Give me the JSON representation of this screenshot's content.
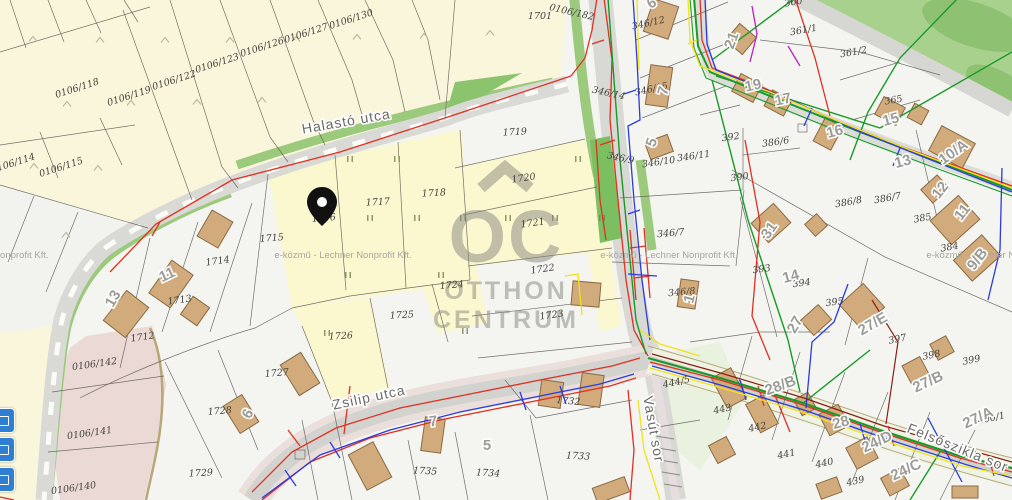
{
  "app": {
    "name": "cadastral-utility-map"
  },
  "watermark": {
    "logo_mark": "OC",
    "logo_line1": "OTTHON",
    "logo_line2": "CENTRUM",
    "provider": "e-közmű - Lechner Nonprofit Kft.",
    "provider_rows": [
      {
        "x": -20,
        "y": 258
      },
      {
        "x": 343,
        "y": 258
      },
      {
        "x": 669,
        "y": 258
      },
      {
        "x": 995,
        "y": 258
      }
    ]
  },
  "pin": {
    "parcel": "1716",
    "color": "#111111"
  },
  "streets": [
    {
      "t": "Halastó utca",
      "x": 347,
      "y": 126,
      "r": -10
    },
    {
      "t": "Zsilip utca",
      "x": 370,
      "y": 402,
      "r": -12
    },
    {
      "t": "Felsőszikla sor",
      "x": 956,
      "y": 452,
      "r": 22
    },
    {
      "t": "Vasút sor",
      "x": 649,
      "y": 430,
      "r": 80
    }
  ],
  "parcel_labels": [
    {
      "t": "0106/114",
      "x": 14,
      "y": 166,
      "r": -18
    },
    {
      "t": "0106/115",
      "x": 62,
      "y": 170,
      "r": -18
    },
    {
      "t": "0106/118",
      "x": 78,
      "y": 91,
      "r": -18
    },
    {
      "t": "0106/119",
      "x": 130,
      "y": 99,
      "r": -18
    },
    {
      "t": "0106/122",
      "x": 175,
      "y": 83,
      "r": -18
    },
    {
      "t": "0106/123",
      "x": 218,
      "y": 66,
      "r": -18
    },
    {
      "t": "0106/126",
      "x": 263,
      "y": 50,
      "r": -18
    },
    {
      "t": "0106/127",
      "x": 307,
      "y": 36,
      "r": -18
    },
    {
      "t": "0106/130",
      "x": 352,
      "y": 22,
      "r": -18
    },
    {
      "t": "1701",
      "x": 540,
      "y": 19,
      "r": 0
    },
    {
      "t": "0106/182",
      "x": 571,
      "y": 15,
      "r": 13
    },
    {
      "t": "0106/142",
      "x": 95,
      "y": 367,
      "r": -8
    },
    {
      "t": "0106/141",
      "x": 90,
      "y": 436,
      "r": -8
    },
    {
      "t": "0106/140",
      "x": 74,
      "y": 491,
      "r": -8
    },
    {
      "t": "1712",
      "x": 143,
      "y": 340,
      "r": -8
    },
    {
      "t": "1713",
      "x": 180,
      "y": 303,
      "r": -8
    },
    {
      "t": "1714",
      "x": 218,
      "y": 264,
      "r": -8
    },
    {
      "t": "1715",
      "x": 272,
      "y": 241,
      "r": -5
    },
    {
      "t": "1716",
      "x": 324,
      "y": 221,
      "r": -5
    },
    {
      "t": "1717",
      "x": 378,
      "y": 205,
      "r": -3
    },
    {
      "t": "1718",
      "x": 434,
      "y": 196,
      "r": -3
    },
    {
      "t": "1719",
      "x": 515,
      "y": 135,
      "r": -3
    },
    {
      "t": "1720",
      "x": 524,
      "y": 181,
      "r": -8
    },
    {
      "t": "1721",
      "x": 533,
      "y": 226,
      "r": -8
    },
    {
      "t": "1722",
      "x": 543,
      "y": 272,
      "r": -8
    },
    {
      "t": "1723",
      "x": 552,
      "y": 318,
      "r": -8
    },
    {
      "t": "1724",
      "x": 452,
      "y": 288,
      "r": -5
    },
    {
      "t": "1725",
      "x": 402,
      "y": 318,
      "r": -3
    },
    {
      "t": "1726",
      "x": 341,
      "y": 339,
      "r": -3
    },
    {
      "t": "1727",
      "x": 277,
      "y": 376,
      "r": -5
    },
    {
      "t": "1728",
      "x": 220,
      "y": 414,
      "r": -5
    },
    {
      "t": "1729",
      "x": 201,
      "y": 476,
      "r": -3
    },
    {
      "t": "1732",
      "x": 568,
      "y": 404,
      "r": 5
    },
    {
      "t": "1733",
      "x": 578,
      "y": 459,
      "r": 3
    },
    {
      "t": "1734",
      "x": 488,
      "y": 476,
      "r": 3
    },
    {
      "t": "1735",
      "x": 425,
      "y": 474,
      "r": 3
    },
    {
      "t": "346/12",
      "x": 649,
      "y": 26,
      "r": -12
    },
    {
      "t": "346/14",
      "x": 608,
      "y": 96,
      "r": 12
    },
    {
      "t": "346/15",
      "x": 652,
      "y": 92,
      "r": -12
    },
    {
      "t": "346/9",
      "x": 620,
      "y": 161,
      "r": 12
    },
    {
      "t": "346/10",
      "x": 659,
      "y": 165,
      "r": -8
    },
    {
      "t": "346/11",
      "x": 694,
      "y": 159,
      "r": -8
    },
    {
      "t": "392",
      "x": 731,
      "y": 140,
      "r": -8
    },
    {
      "t": "386/6",
      "x": 776,
      "y": 145,
      "r": -8
    },
    {
      "t": "390",
      "x": 740,
      "y": 180,
      "r": -8
    },
    {
      "t": "346/7",
      "x": 671,
      "y": 236,
      "r": -5
    },
    {
      "t": "346/8",
      "x": 682,
      "y": 295,
      "r": -5
    },
    {
      "t": "393",
      "x": 762,
      "y": 272,
      "r": -8
    },
    {
      "t": "386/8",
      "x": 849,
      "y": 205,
      "r": -10
    },
    {
      "t": "386/7",
      "x": 888,
      "y": 201,
      "r": -10
    },
    {
      "t": "385",
      "x": 923,
      "y": 221,
      "r": -10
    },
    {
      "t": "384",
      "x": 950,
      "y": 250,
      "r": -10
    },
    {
      "t": "394",
      "x": 802,
      "y": 286,
      "r": -8
    },
    {
      "t": "395",
      "x": 835,
      "y": 305,
      "r": -8
    },
    {
      "t": "361/1",
      "x": 804,
      "y": 33,
      "r": -10
    },
    {
      "t": "361/2",
      "x": 854,
      "y": 55,
      "r": -10
    },
    {
      "t": "365",
      "x": 894,
      "y": 103,
      "r": -10
    },
    {
      "t": "360",
      "x": 794,
      "y": 5,
      "r": -10
    },
    {
      "t": "397",
      "x": 898,
      "y": 342,
      "r": -12
    },
    {
      "t": "398",
      "x": 932,
      "y": 358,
      "r": -12
    },
    {
      "t": "399",
      "x": 972,
      "y": 363,
      "r": -12
    },
    {
      "t": "400/1",
      "x": 992,
      "y": 421,
      "r": -12
    },
    {
      "t": "439",
      "x": 856,
      "y": 484,
      "r": -12
    },
    {
      "t": "440",
      "x": 825,
      "y": 466,
      "r": -12
    },
    {
      "t": "441",
      "x": 787,
      "y": 457,
      "r": -12
    },
    {
      "t": "442",
      "x": 758,
      "y": 430,
      "r": -12
    },
    {
      "t": "443",
      "x": 723,
      "y": 412,
      "r": -12
    },
    {
      "t": "444/5",
      "x": 677,
      "y": 385,
      "r": -12
    }
  ],
  "house_numbers": [
    {
      "t": "13",
      "x": 117,
      "y": 301,
      "r": -60
    },
    {
      "t": "11",
      "x": 169,
      "y": 279,
      "r": -25
    },
    {
      "t": "6",
      "x": 252,
      "y": 416,
      "r": -62
    },
    {
      "t": "7",
      "x": 434,
      "y": 426,
      "r": -8
    },
    {
      "t": "5",
      "x": 487,
      "y": 450,
      "r": 0
    },
    {
      "t": "7",
      "x": 668,
      "y": 92,
      "r": -75
    },
    {
      "t": "5",
      "x": 656,
      "y": 144,
      "r": -70
    },
    {
      "t": "1",
      "x": 694,
      "y": 300,
      "r": -75
    },
    {
      "t": "6",
      "x": 654,
      "y": 7,
      "r": -30
    },
    {
      "t": "21",
      "x": 736,
      "y": 42,
      "r": -70
    },
    {
      "t": "19",
      "x": 754,
      "y": 90,
      "r": -12
    },
    {
      "t": "17",
      "x": 784,
      "y": 104,
      "r": -12
    },
    {
      "t": "16",
      "x": 836,
      "y": 136,
      "r": -15
    },
    {
      "t": "15",
      "x": 892,
      "y": 124,
      "r": -15
    },
    {
      "t": "13",
      "x": 904,
      "y": 166,
      "r": -15
    },
    {
      "t": "10/A",
      "x": 956,
      "y": 156,
      "r": -35
    },
    {
      "t": "31",
      "x": 773,
      "y": 233,
      "r": -55
    },
    {
      "t": "14",
      "x": 792,
      "y": 281,
      "r": -15
    },
    {
      "t": "27",
      "x": 799,
      "y": 327,
      "r": -60
    },
    {
      "t": "27/E",
      "x": 875,
      "y": 328,
      "r": -30
    },
    {
      "t": "9/B",
      "x": 981,
      "y": 262,
      "r": -52
    },
    {
      "t": "11",
      "x": 966,
      "y": 215,
      "r": -52
    },
    {
      "t": "12",
      "x": 944,
      "y": 193,
      "r": -52
    },
    {
      "t": "28/B",
      "x": 782,
      "y": 390,
      "r": -20
    },
    {
      "t": "28",
      "x": 842,
      "y": 427,
      "r": -15
    },
    {
      "t": "24/D",
      "x": 879,
      "y": 446,
      "r": -25
    },
    {
      "t": "24/C",
      "x": 908,
      "y": 474,
      "r": -25
    },
    {
      "t": "27/B",
      "x": 930,
      "y": 386,
      "r": -25
    },
    {
      "t": "27/A",
      "x": 980,
      "y": 422,
      "r": -25
    }
  ],
  "tree_marks": [
    [
      350,
      159
    ],
    [
      397,
      159
    ],
    [
      578,
      159
    ],
    [
      370,
      218
    ],
    [
      417,
      218
    ],
    [
      463,
      218
    ],
    [
      508,
      218
    ],
    [
      555,
      218
    ],
    [
      602,
      218
    ],
    [
      348,
      275
    ],
    [
      441,
      275
    ],
    [
      327,
      333
    ],
    [
      465,
      331
    ]
  ],
  "slope_marks": [
    [
      33,
      39
    ],
    [
      100,
      40
    ],
    [
      165,
      40
    ],
    [
      230,
      40
    ],
    [
      296,
      39
    ],
    [
      357,
      37
    ],
    [
      424,
      36
    ],
    [
      490,
      33
    ],
    [
      67,
      104
    ],
    [
      131,
      103
    ],
    [
      197,
      102
    ],
    [
      262,
      100
    ],
    [
      34,
      166
    ],
    [
      98,
      168
    ],
    [
      66,
      235
    ]
  ],
  "colors": {
    "highlight_parcel": "#fbf7cf",
    "cream": "#faf6dc",
    "pink": "#ead9d5",
    "park": "#a9d18e",
    "building": "#d2ab7d",
    "road": "#d9d9d5",
    "utility_red": "#e03022",
    "utility_green": "#199a28",
    "utility_blue": "#2b3bdf",
    "utility_yellow": "#f2e21a",
    "utility_darkred": "#8b2015",
    "utility_magenta": "#c01ec0"
  },
  "controls": [
    {
      "id": "map-control-1"
    },
    {
      "id": "map-control-2"
    },
    {
      "id": "map-control-3"
    }
  ]
}
